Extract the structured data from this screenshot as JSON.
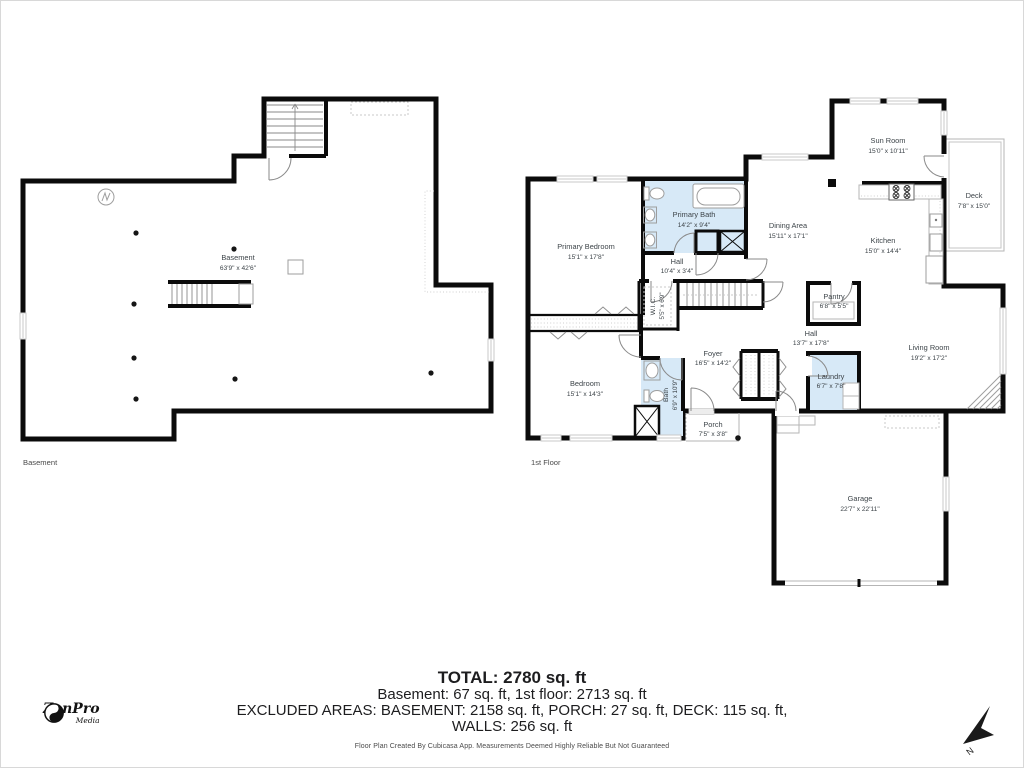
{
  "floors": {
    "basement": {
      "floor_label": "Basement",
      "room": {
        "name": "Basement",
        "dims": "63'9\" x 42'6\""
      }
    },
    "first": {
      "floor_label": "1st Floor",
      "rooms": {
        "primary_bedroom": {
          "name": "Primary Bedroom",
          "dims": "15'1\" x 17'8\""
        },
        "primary_bath": {
          "name": "Primary Bath",
          "dims": "14'2\" x 9'4\""
        },
        "hall_upper": {
          "name": "Hall",
          "dims": "10'4\" x 3'4\""
        },
        "wic": {
          "name": "W.I.C.",
          "dims": "5'5\" x 6'9\""
        },
        "bedroom": {
          "name": "Bedroom",
          "dims": "15'1\" x 14'3\""
        },
        "bath": {
          "name": "Bath",
          "dims": "6'9\" x 10'9\""
        },
        "foyer": {
          "name": "Foyer",
          "dims": "16'5\" x 14'2\""
        },
        "porch": {
          "name": "Porch",
          "dims": "7'5\" x 3'8\""
        },
        "dining_area": {
          "name": "Dining Area",
          "dims": "15'11\" x 17'1\""
        },
        "kitchen": {
          "name": "Kitchen",
          "dims": "15'0\" x 14'4\""
        },
        "sun_room": {
          "name": "Sun Room",
          "dims": "15'0\" x 10'11\""
        },
        "deck": {
          "name": "Deck",
          "dims": "7'8\" x 15'0\""
        },
        "pantry": {
          "name": "Pantry",
          "dims": "6'8\" x 5'5\""
        },
        "hall": {
          "name": "Hall",
          "dims": "13'7\" x 17'8\""
        },
        "laundry": {
          "name": "Laundry",
          "dims": "6'7\" x 7'8\""
        },
        "living_room": {
          "name": "Living Room",
          "dims": "19'2\" x 17'2\""
        },
        "garage": {
          "name": "Garage",
          "dims": "22'7\" x 22'11\""
        }
      }
    }
  },
  "summary": {
    "total": "TOTAL: 2780 sq. ft",
    "by_floor": "Basement: 67 sq. ft, 1st floor: 2713 sq. ft",
    "excluded": "EXCLUDED AREAS: BASEMENT: 2158 sq. ft, PORCH: 27 sq. ft, DECK: 115 sq. ft,",
    "walls": "WALLS: 256 sq. ft",
    "disclaimer": "Floor Plan Created By Cubicasa App. Measurements Deemed Highly Reliable But Not Guaranteed"
  },
  "branding": {
    "name": "ZenPro",
    "tagline": "Media",
    "icon": "yin-yang-icon"
  },
  "compass": {
    "north_label": "N",
    "icon": "north-arrow-icon"
  },
  "colors": {
    "wall": "#0b0b0b",
    "wet_room_fill": "#d7e9f7",
    "label": "#3d4449",
    "fixture": "#9e9e9e",
    "window": "#c9c9c9"
  }
}
